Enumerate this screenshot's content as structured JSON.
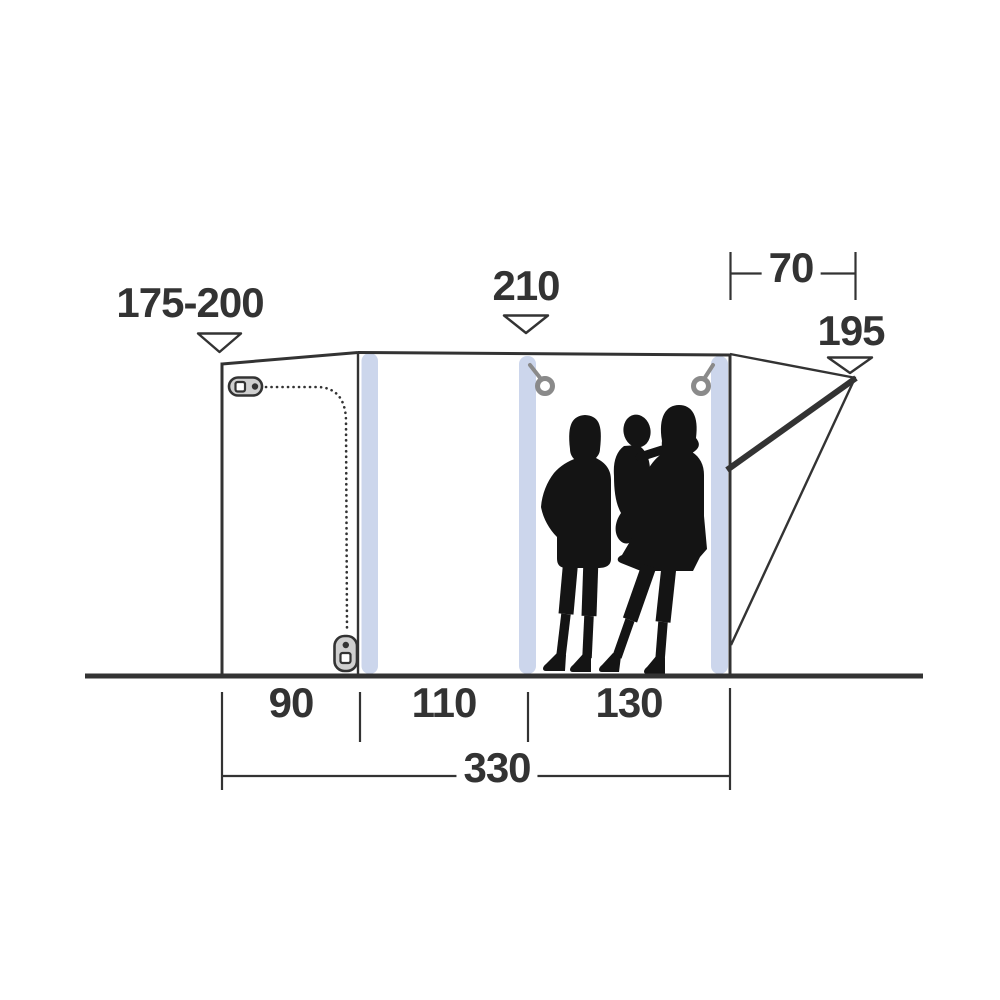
{
  "diagram": {
    "title": "Tent side-profile dimension diagram",
    "labels": {
      "left_height": "175-200",
      "center_height": "210",
      "canopy_depth": "70",
      "canopy_height": "195",
      "section_left": "90",
      "section_middle": "110",
      "section_right": "130",
      "total_width": "330"
    },
    "colors": {
      "line": "#333333",
      "beam": "#ccd6ec",
      "silhouette": "#141414",
      "hardware_gray": "#8a8a8a",
      "zipper_pull_fill": "#cfcfcf",
      "background": "#ffffff"
    },
    "icons": {
      "arrow_175_200": "arrow-down-triangle-icon",
      "arrow_210": "arrow-down-triangle-icon",
      "arrow_195": "arrow-down-triangle-icon",
      "zipper_top": "zipper-pull-icon",
      "zipper_bottom": "zipper-pull-icon",
      "tieback_left": "tieback-ring-icon",
      "tieback_right": "tieback-ring-icon",
      "people": "family-silhouette"
    }
  }
}
